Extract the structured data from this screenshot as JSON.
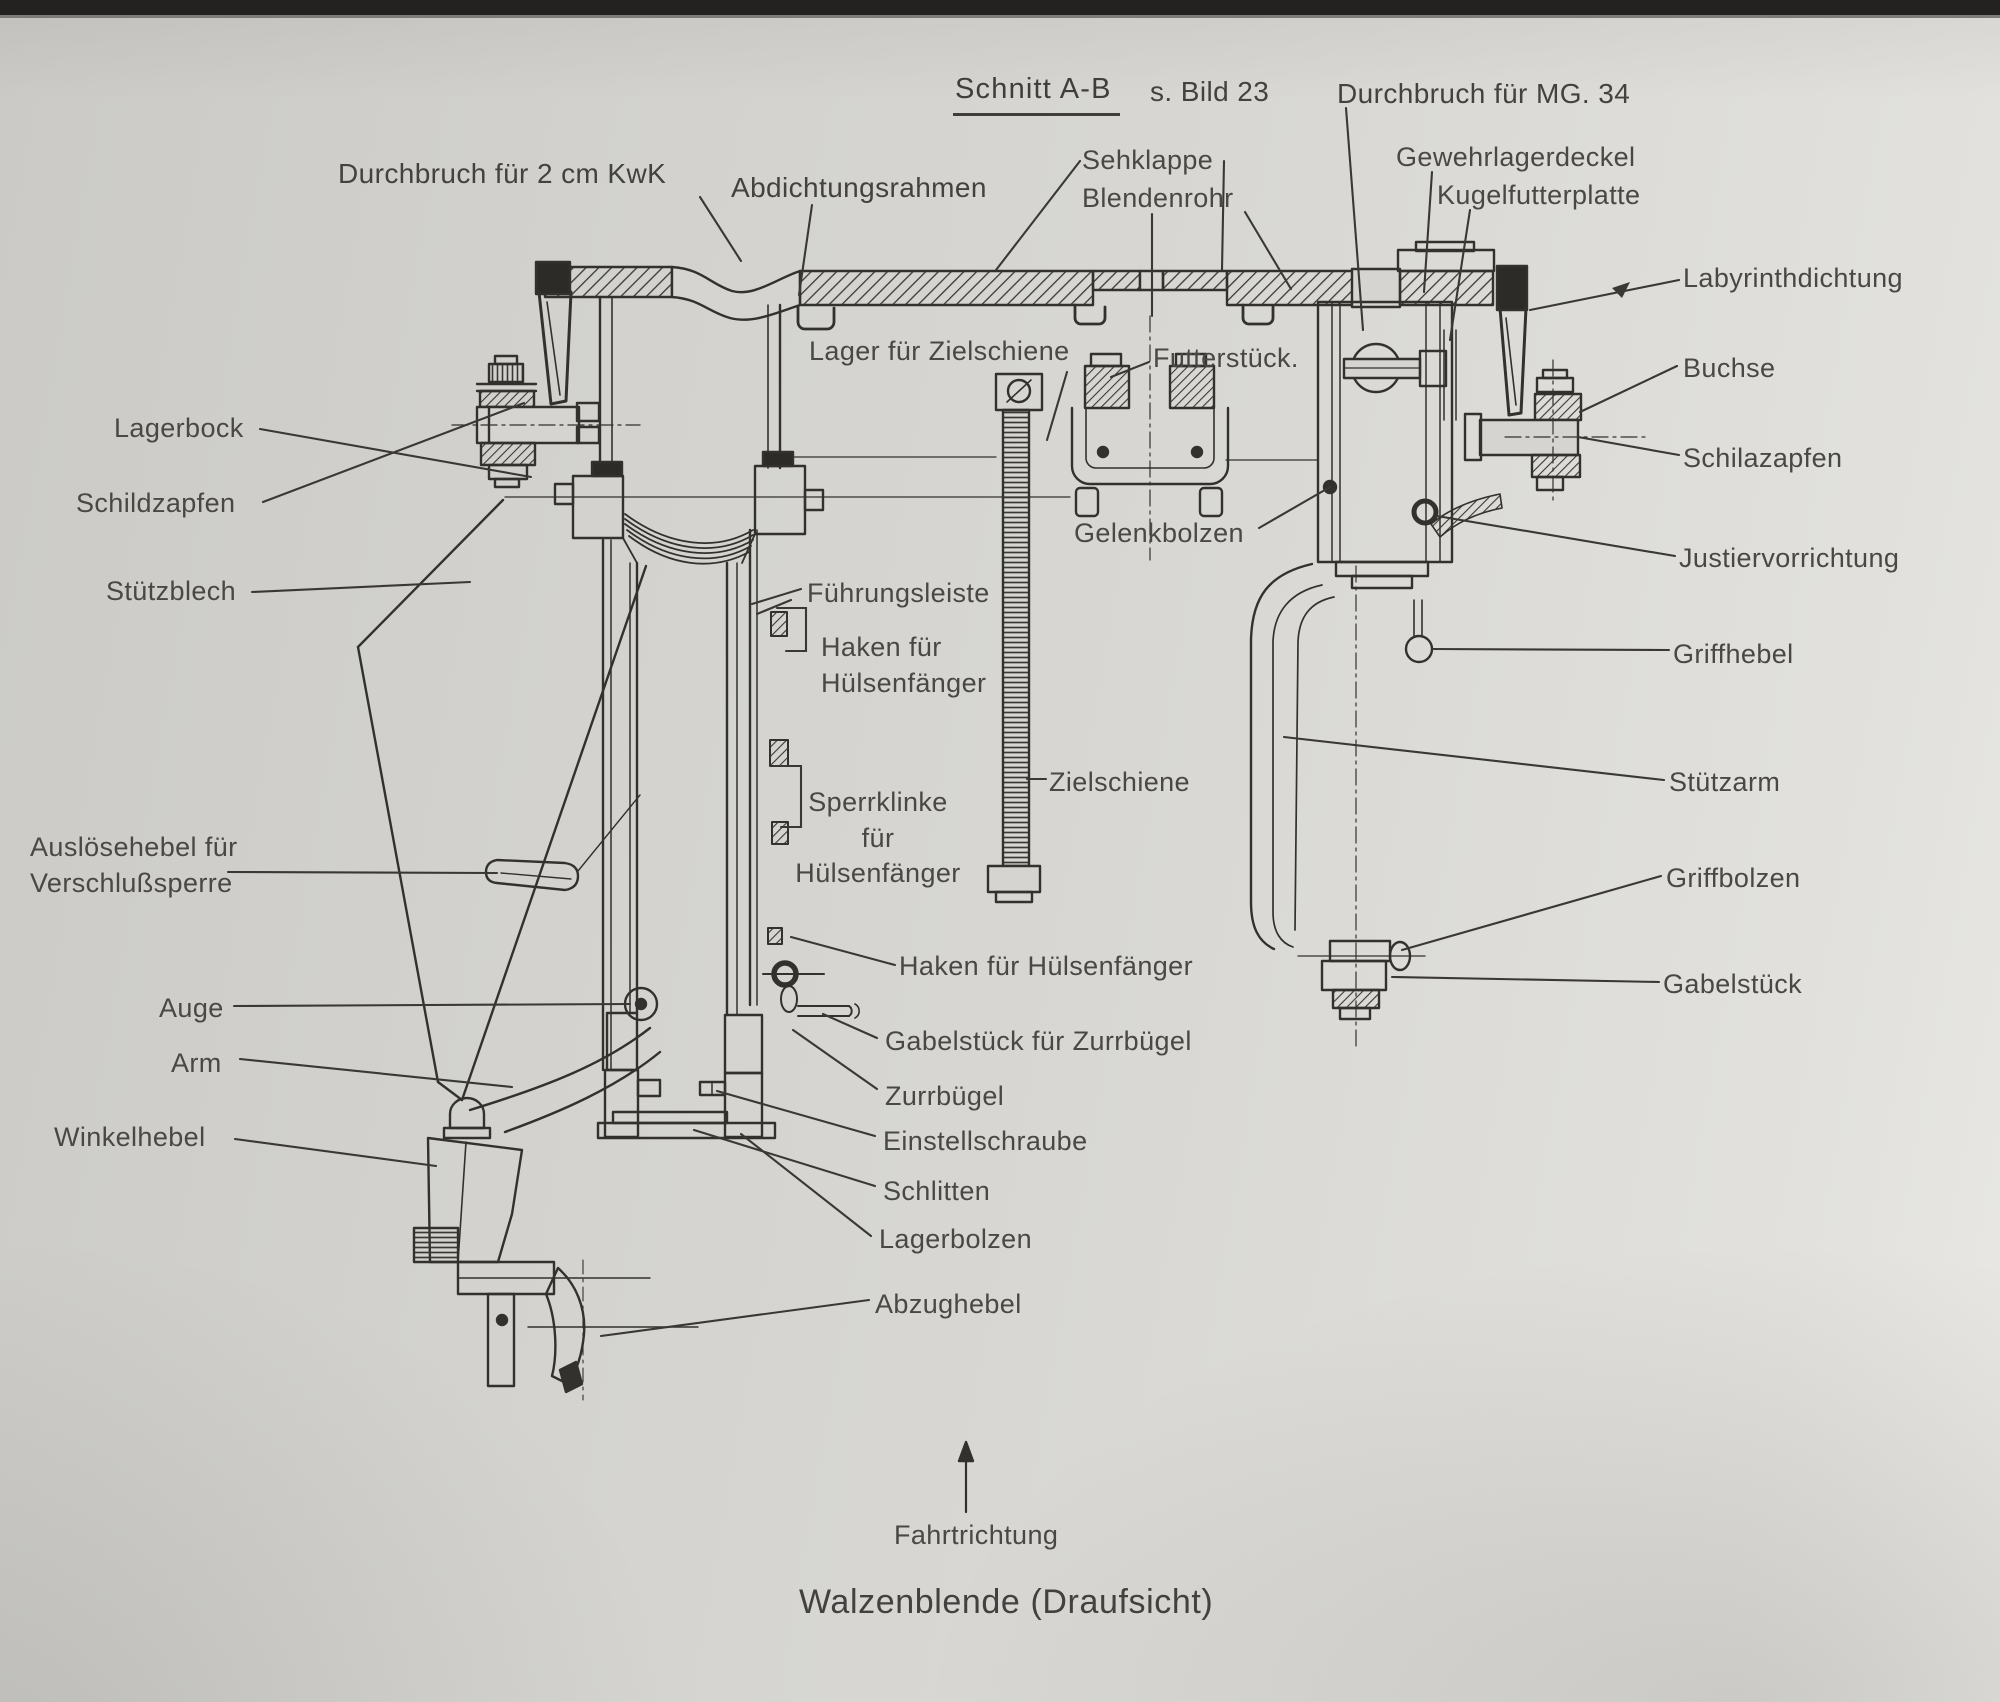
{
  "figure": {
    "section_title": "Schnitt A-B",
    "section_ref": "s. Bild 23",
    "caption": "Walzenblende (Draufsicht)",
    "direction_label": "Fahrtrichtung"
  },
  "colors": {
    "paper": "#d5d4d0",
    "ink": "#33312d",
    "text": "#4a4845"
  },
  "labels": {
    "durchbruch_kwk": "Durchbruch für 2 cm KwK",
    "abdichtungsrahmen": "Abdichtungsrahmen",
    "sehklappe": "Sehklappe",
    "blendenrohr": "Blendenrohr",
    "durchbruch_mg34": "Durchbruch für MG. 34",
    "gewehrlagerdeckel": "Gewehrlagerdeckel",
    "kugelfutterplatte": "Kugelfutterplatte",
    "labyrinthdichtung": "Labyrinthdichtung",
    "buchse": "Buchse",
    "schilazapfen": "Schilazapfen",
    "justiervorrichtung": "Justiervorrichtung",
    "griffhebel": "Griffhebel",
    "stuetzarm": "Stützarm",
    "griffbolzen": "Griffbolzen",
    "gabelstueck": "Gabelstück",
    "lagerbock": "Lagerbock",
    "schildzapfen": "Schildzapfen",
    "stuetzblech": "Stützblech",
    "ausloesehebel": "Auslösehebel für\nVerschlußsperre",
    "auge": "Auge",
    "arm": "Arm",
    "winkelhebel": "Winkelhebel",
    "lager_fuer_zielschiene": "Lager für Zielschiene",
    "futterstueck": "Futterstück.",
    "gelenkbolzen": "Gelenkbolzen",
    "fuehrungsleiste": "Führungsleiste",
    "haken_fuer_huelsenfaenger_oben": "Haken für\nHülsenfänger",
    "sperrklinke_fuer_huelsenfaenger": "Sperrklinke\nfür\nHülsenfänger",
    "zielschiene": "Zielschiene",
    "haken_fuer_huelsenfaenger_unten": "Haken für Hülsenfänger",
    "gabelstueck_fuer_zurrbuegel": "Gabelstück für Zurrbügel",
    "zurrbuegel": "Zurrbügel",
    "einstellschraube": "Einstellschraube",
    "schlitten": "Schlitten",
    "lagerbolzen": "Lagerbolzen",
    "abzughebel": "Abzughebel"
  }
}
